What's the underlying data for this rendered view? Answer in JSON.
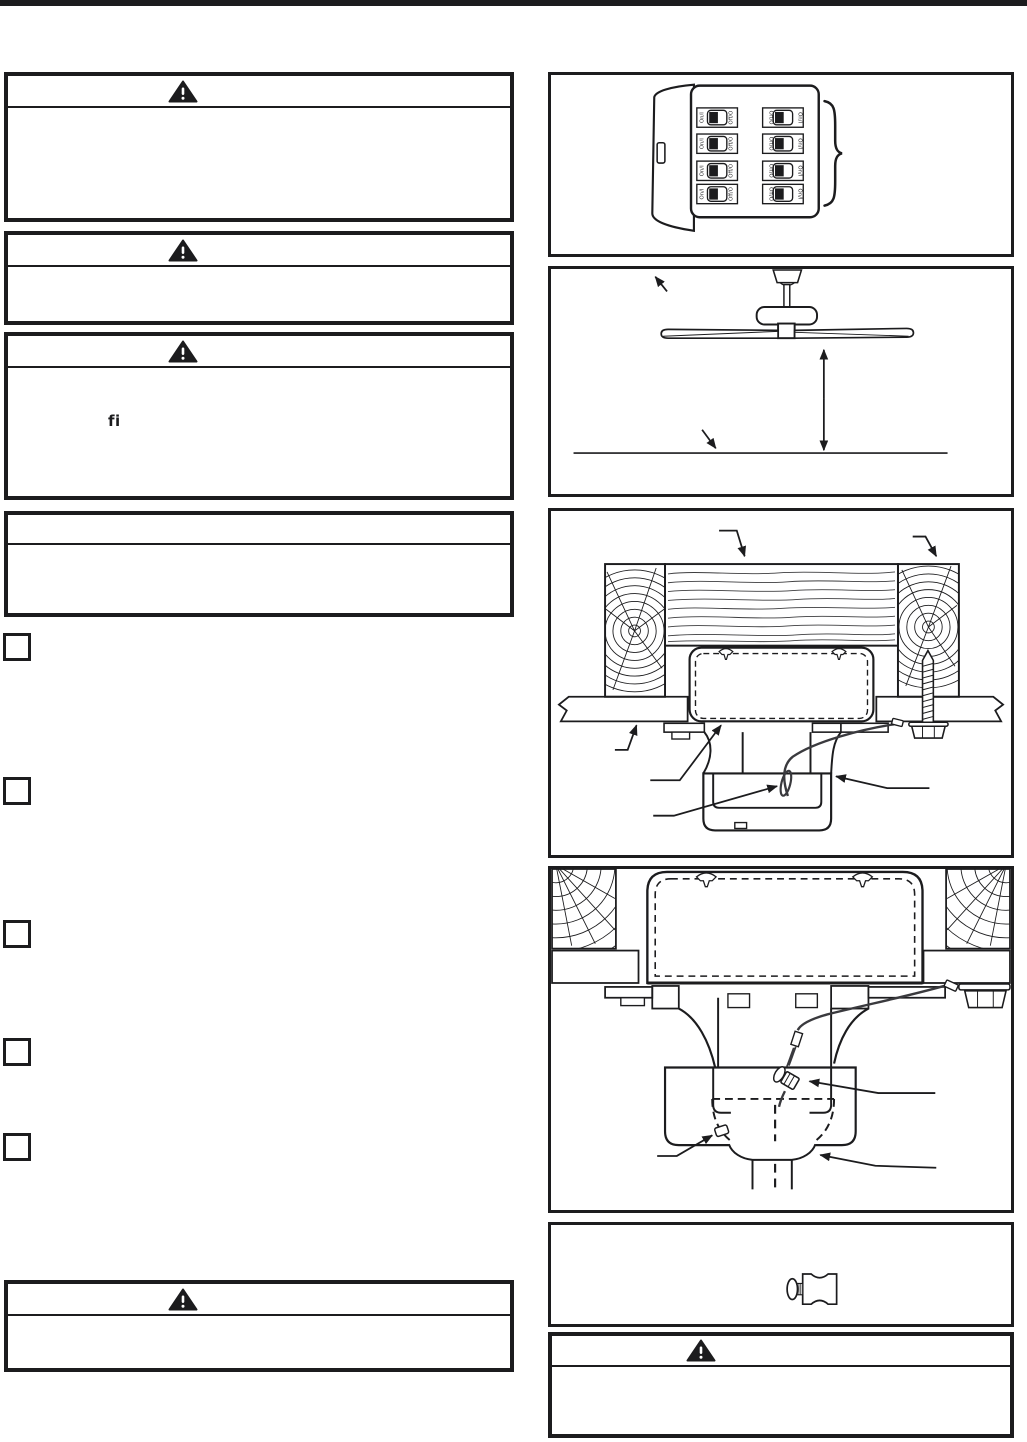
{
  "page": {
    "kind": "instruction-manual-page",
    "ink": "#1c1c1e",
    "background": "#ffffff"
  },
  "left_column": {
    "alert_boxes": [
      {
        "id": "warning-box-1",
        "icon": "warning-triangle",
        "header_text": "",
        "body_text": ""
      },
      {
        "id": "warning-box-2",
        "icon": "warning-triangle",
        "header_text": "",
        "body_text": ""
      },
      {
        "id": "warning-box-3",
        "icon": "warning-triangle",
        "header_text": "",
        "body_text": "fi"
      },
      {
        "id": "notice-box",
        "icon": "none",
        "header_text": "",
        "body_text": ""
      },
      {
        "id": "warning-box-4",
        "icon": "warning-triangle",
        "header_text": "",
        "body_text": ""
      }
    ],
    "step_markers": {
      "count": 5
    }
  },
  "right_column": {
    "figures": [
      {
        "id": "circuit-breaker-panel",
        "breaker_rows": 4,
        "breaker_columns": 2,
        "labels": {
          "on": "On/I",
          "off": "Off/O"
        }
      },
      {
        "id": "fan-floor-clearance"
      },
      {
        "id": "joist-outlet-box-cross-section"
      },
      {
        "id": "hanger-bracket-cable-detail"
      },
      {
        "id": "cable-clamp-part"
      }
    ],
    "alert_box": {
      "id": "warning-box-5",
      "icon": "warning-triangle",
      "header_text": "",
      "body_text": ""
    }
  }
}
